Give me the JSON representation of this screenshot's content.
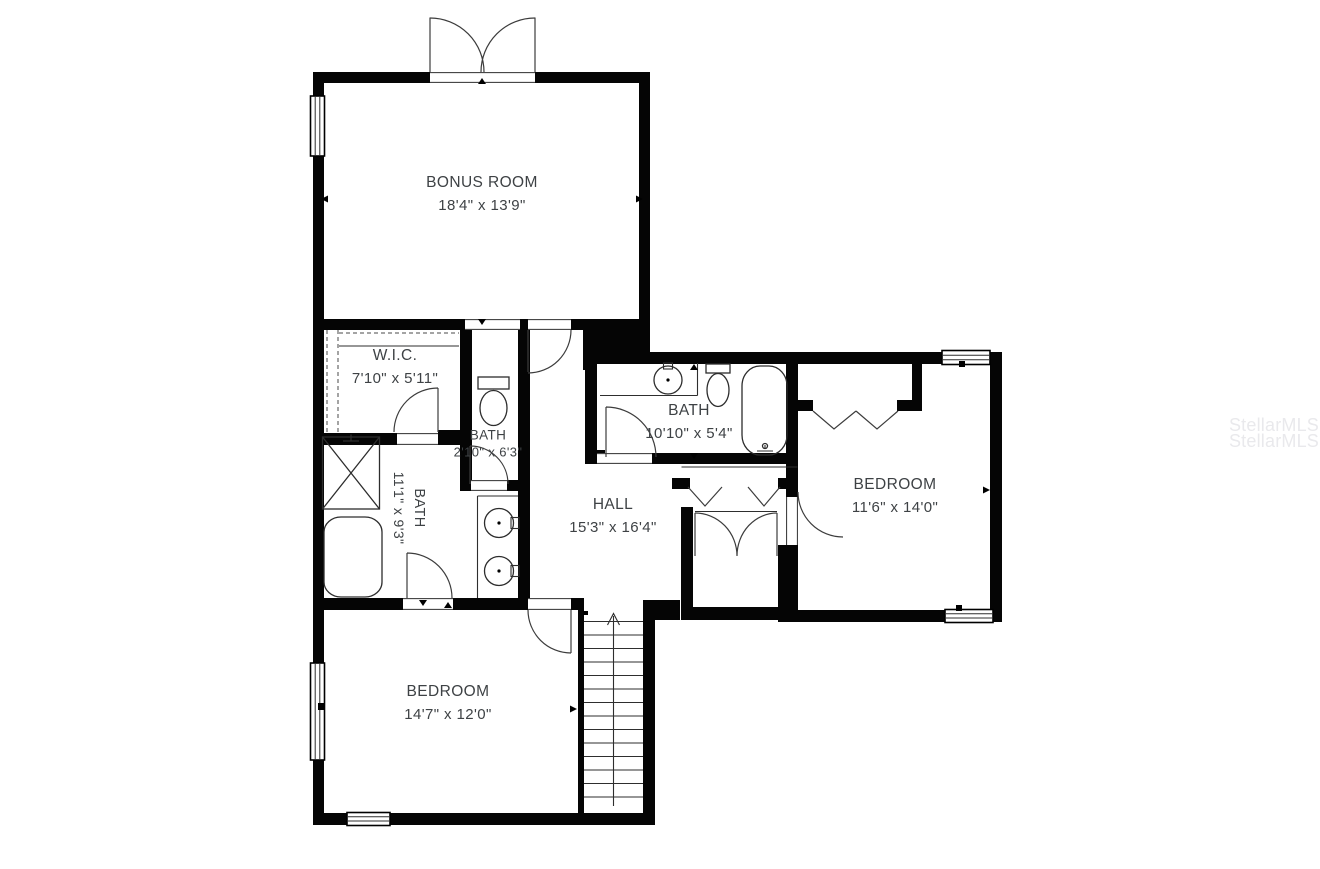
{
  "watermark": {
    "lines": [
      "StellarMLS",
      "StellarMLS"
    ],
    "color": "#e9e9ec"
  },
  "rooms": [
    {
      "name": "BONUS ROOM",
      "dimensions": "18'4\" x 13'9\""
    },
    {
      "name": "W.I.C.",
      "dimensions": "7'10\" x 5'11\""
    },
    {
      "name": "BATH",
      "dimensions": "2'10\" x 6'3\""
    },
    {
      "name": "BATH",
      "dimensions": "11'1\" x 9'3\""
    },
    {
      "name": "HALL",
      "dimensions": "15'3\" x 16'4\""
    },
    {
      "name": "BATH",
      "dimensions": "10'10\" x 5'4\""
    },
    {
      "name": "BEDROOM",
      "dimensions": "11'6\" x 14'0\""
    },
    {
      "name": "BEDROOM",
      "dimensions": "14'7\" x 12'0\""
    }
  ],
  "colors": {
    "wall": "#000000",
    "line": "#3c3c3c",
    "label": "#3e4245",
    "background": "#ffffff"
  }
}
